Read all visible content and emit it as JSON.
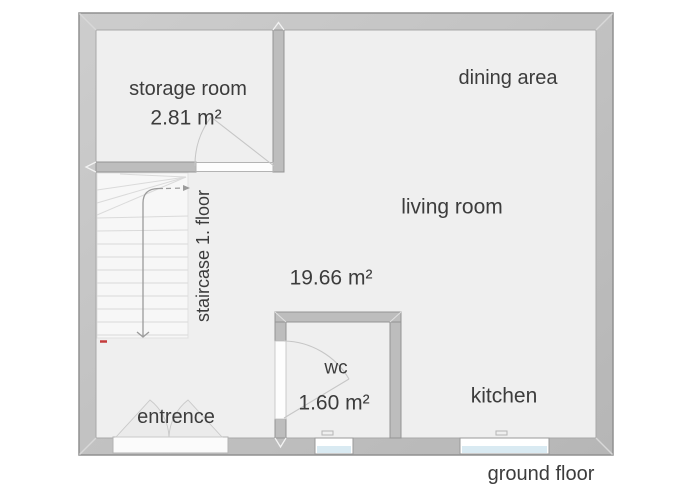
{
  "plan": {
    "floor_label": "ground floor",
    "rooms": {
      "storage": {
        "label": "storage room",
        "area": "2.81 m²"
      },
      "dining": {
        "label": "dining area"
      },
      "living": {
        "label": "living room",
        "area": "19.66 m²"
      },
      "staircase": {
        "label": "staircase 1. floor"
      },
      "wc": {
        "label": "wc",
        "area": "1.60 m²"
      },
      "entrance": {
        "label": "entrence"
      },
      "kitchen": {
        "label": "kitchen"
      }
    }
  },
  "colors": {
    "background": "#ffffff",
    "floor": "#efefef",
    "wall_fill": "#c2c2c2",
    "wall_outline": "#909090",
    "interior_wall_fill": "#bdbdbd",
    "stair_fill": "#f7f7f7",
    "stair_tread_line": "#dadada",
    "walk_line": "#9b9b9b",
    "door_swing_line": "#c6c6c6",
    "window_glass": "#d9eaf2",
    "threshold": "#fdfdfd",
    "start_mark": "#c43c3c",
    "label_text": "#3c3c3c"
  }
}
